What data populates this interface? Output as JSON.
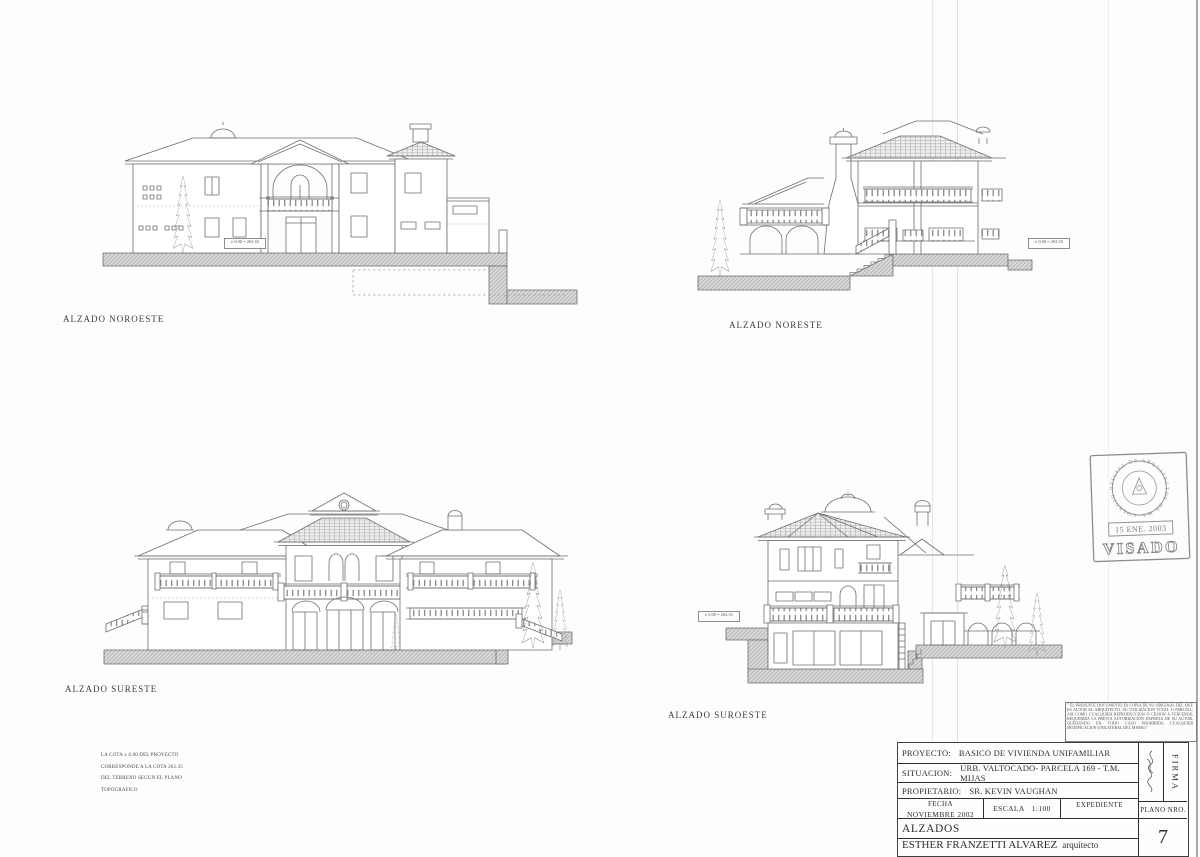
{
  "elevations": [
    {
      "id": "noroeste",
      "label": "ALZADO NOROESTE"
    },
    {
      "id": "noreste",
      "label": "ALZADO NORESTE"
    },
    {
      "id": "sureste",
      "label": "ALZADO SURESTE"
    },
    {
      "id": "suroeste",
      "label": "ALZADO SUROESTE"
    }
  ],
  "datum_label": "± 0.00 = 263.35",
  "note": {
    "lines": [
      "LA COTA ± 0.00 DEL PROYECTO",
      "CORRESPONDE A LA COTA 263.35",
      "DEL TERRENO SEGUN EL PLANO",
      "TOPOGRAFICO"
    ]
  },
  "disclaimer": {
    "text": "\" EL PRESENTE DOCUMENTO ES COPIA DE SU ORIGINAL DEL QUE ES AUTOR EL ARQUITECTO. SU UTILIZACION TOTAL O PARCIAL, ASI COMO CUALQUIER REPRODUCCION O CESION A TERCEROS, REQUERIRA LA PREVIA AUTORIZACION EXPRESA DE SU AUTOR, QUEDANDO EN TODO CASO PROHIBIDA CUALQUIER MODIFICACION UNILATERAL DEL MISMO.\""
  },
  "stamp": {
    "circle_text": "COLEGIO OFICIAL DE ARQUITECTOS DE MALAGA",
    "date": "15 ENE. 2003",
    "visado": "VISADO"
  },
  "title_block": {
    "proyecto_label": "PROYECTO:",
    "proyecto_value": "BASICO DE VIVIENDA UNIFAMILIAR",
    "situacion_label": "SITUACION:",
    "situacion_value": "URB. VALTOCADO- PARCELA 169 - T.M. MIJAS",
    "propietario_label": "PROPIETARIO:",
    "propietario_value": "SR. KEVIN VAUGHAN",
    "fecha_label": "FECHA",
    "fecha_value": "NOVIEMBRE 2002",
    "escala_label": "ESCALA",
    "escala_value": "1:100",
    "expediente_label": "EXPEDIENTE",
    "firma_label": "FIRMA",
    "plano_label": "PLANO NRO.",
    "plano_value": "7",
    "titulo": "ALZADOS",
    "autor": "ESTHER FRANZETTI ALVAREZ",
    "autor_sufijo": "arquitecto"
  },
  "colors": {
    "line": "#6e6e6e",
    "ground": "#d9d9d9",
    "border": "#3e3e3e"
  }
}
